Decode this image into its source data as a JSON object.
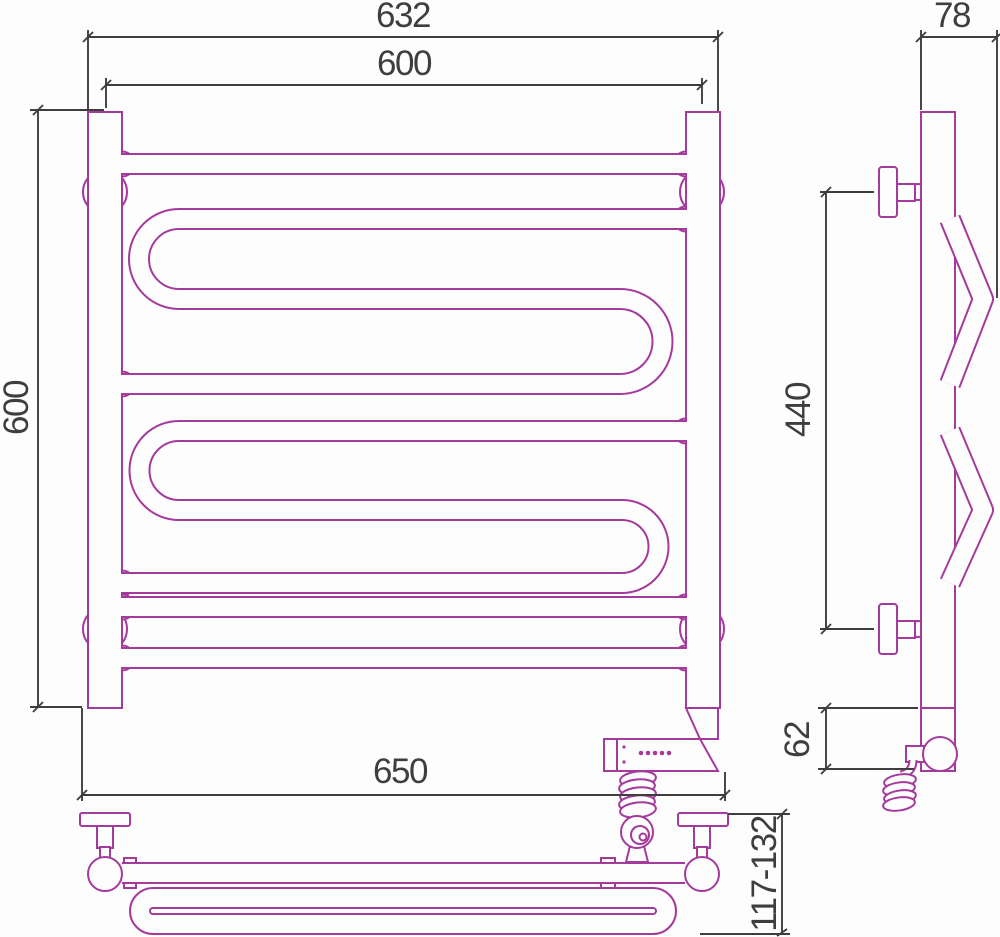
{
  "colors": {
    "outline": "#A53A9D",
    "dimension": "#3E3E3E",
    "background": "#FDFDFD"
  },
  "dimensions": {
    "overall_width": "632",
    "center_width": "600",
    "height": "600",
    "depth": "78",
    "bracket_span": "440",
    "heater_drop": "62",
    "base_width": "650",
    "wall_offset": "117-132"
  }
}
